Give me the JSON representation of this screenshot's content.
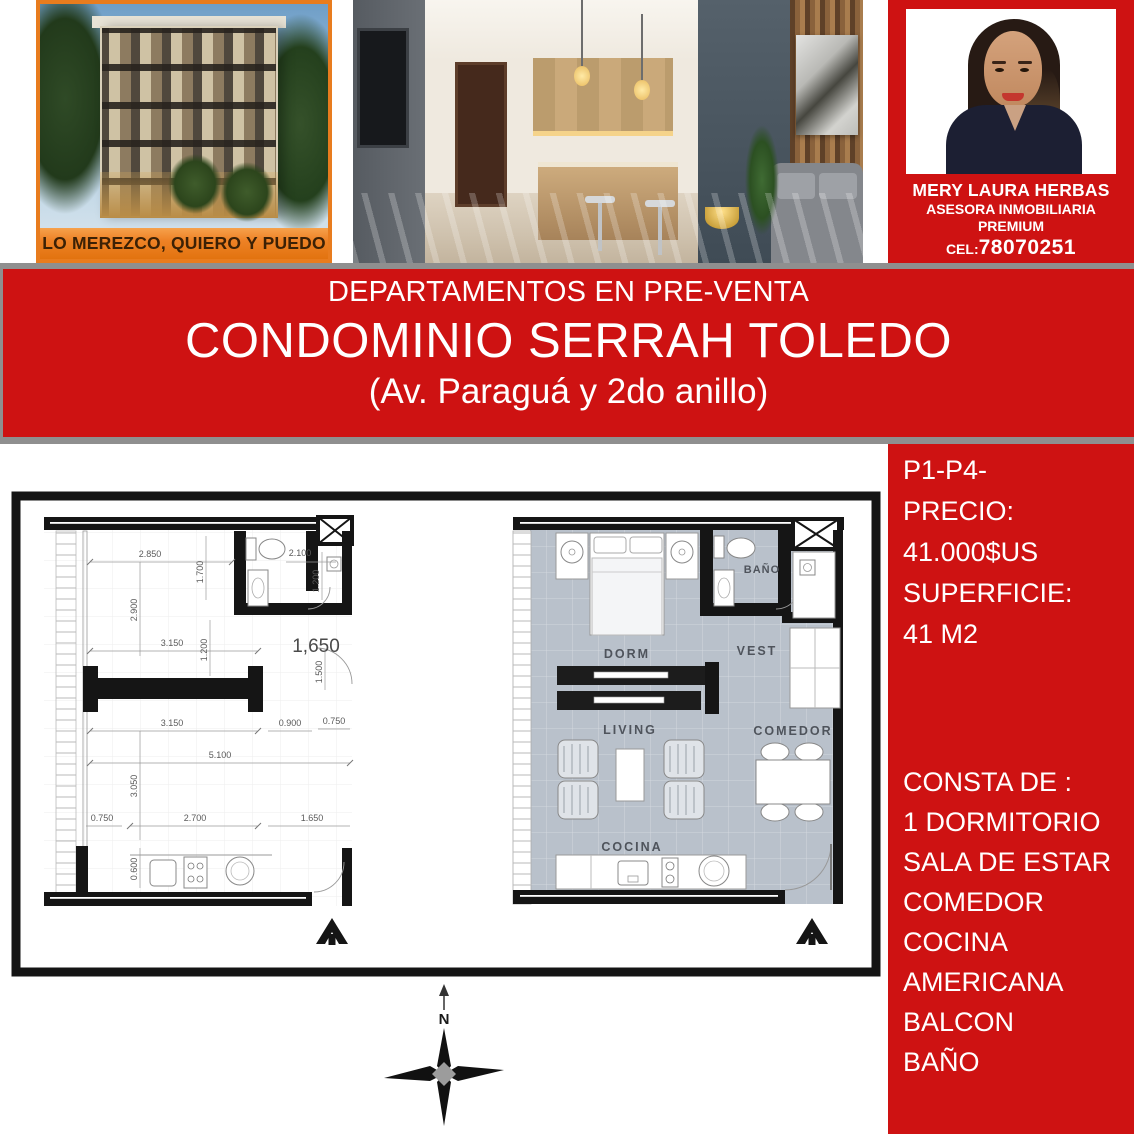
{
  "top": {
    "building": {
      "caption": "LO MEREZCO, QUIERO Y PUEDO"
    },
    "agent": {
      "name": "MERY LAURA HERBAS",
      "role": "ASESORA INMOBILIARIA",
      "tier": "PREMIUM",
      "phone_label": "CEL:",
      "phone_number": "78070251"
    }
  },
  "banner": {
    "line1": "DEPARTAMENTOS EN PRE-VENTA",
    "line2": "CONDOMINIO SERRAH TOLEDO",
    "line3": "(Av. Paraguá y 2do anillo)"
  },
  "sidebar": {
    "lines_top": [
      "P1-P4-",
      "PRECIO:",
      "41.000$US",
      "SUPERFICIE:",
      "41 M2"
    ],
    "lines_bottom": [
      "CONSTA DE :",
      "1 DORMITORIO",
      "SALA DE ESTAR",
      "COMEDOR",
      "COCINA",
      "AMERICANA",
      "BALCON",
      "BAÑO"
    ]
  },
  "plans": {
    "left": {
      "dims": [
        "2.850",
        "1.700",
        "2.900",
        "2.100",
        "1.200",
        "3.150",
        "1.200",
        "1,650",
        "1.500",
        "3.150",
        "0.900",
        "0.750",
        "5.100",
        "3.050",
        "0.750",
        "2.700",
        "1.650",
        "0.600"
      ]
    },
    "right": {
      "rooms": [
        "BAÑO",
        "DORM",
        "VEST",
        "LIVING",
        "COMEDOR",
        "COCINA"
      ]
    },
    "compass": {
      "north_label": "N"
    }
  },
  "colors": {
    "red": "#ce1212",
    "orange": "#e87c1e",
    "gray_border": "#8f8f8f"
  }
}
